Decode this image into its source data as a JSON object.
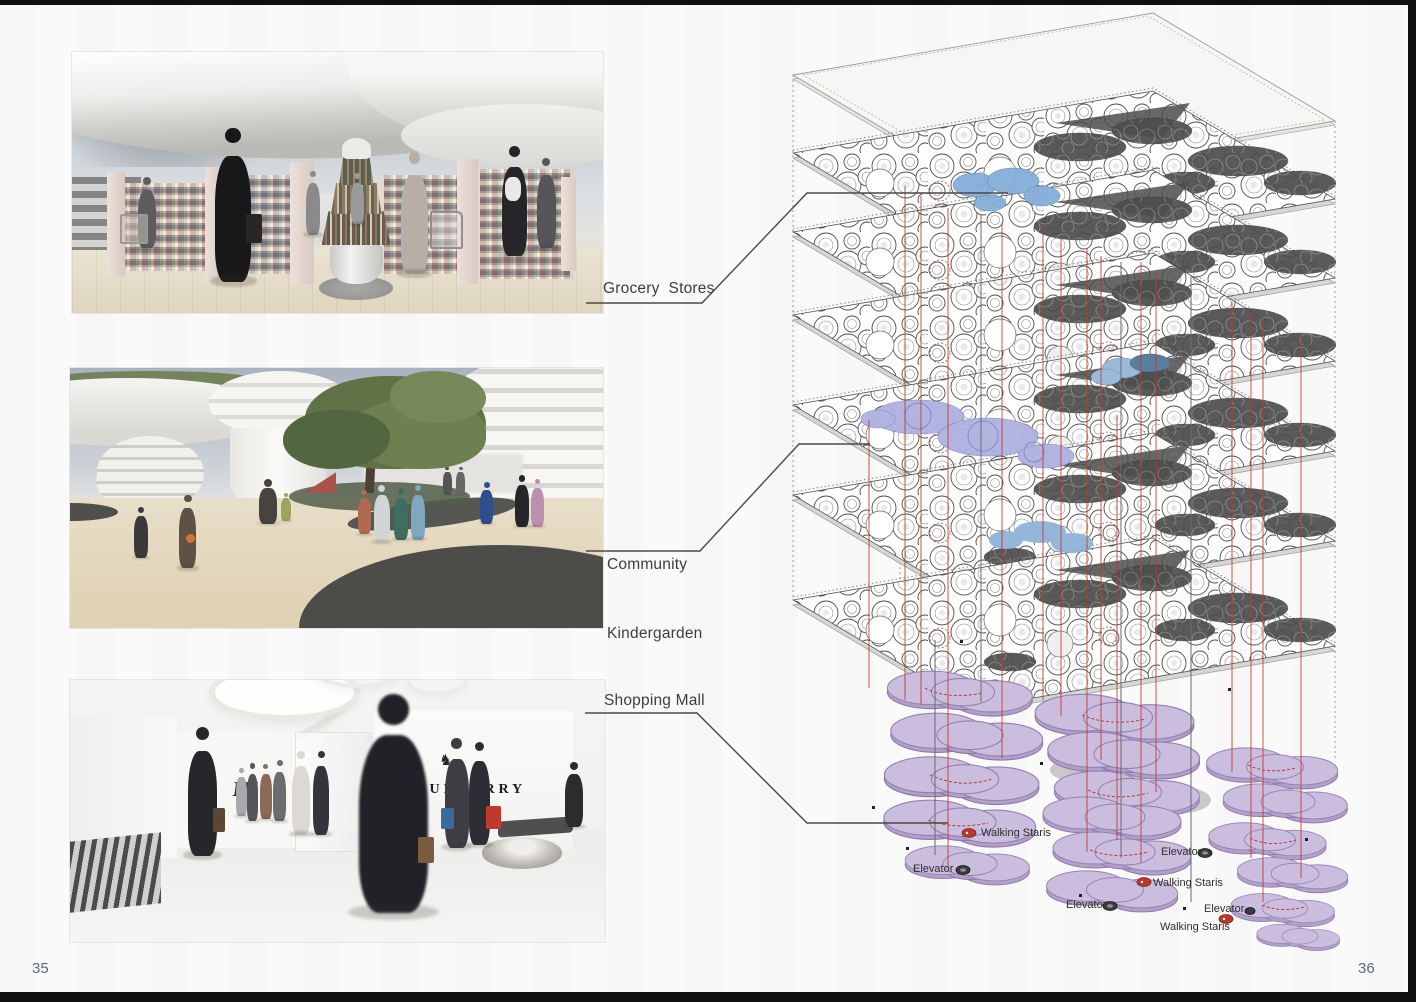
{
  "page": {
    "left_number": "35",
    "right_number": "36"
  },
  "callouts": {
    "grocery": "Grocery  Stores",
    "kindergarten_line1": "Community",
    "kindergarten_line2": "Kindergarden",
    "mall": "Shopping Mall"
  },
  "photos": {
    "mall": {
      "lv": "LV",
      "burberry": "BURBERRY",
      "burberry_city": "LONDON"
    }
  },
  "diagram": {
    "annotations": [
      {
        "text": "Walking Staris"
      },
      {
        "text": "Elevator"
      },
      {
        "text": "Elevator"
      },
      {
        "text": "Walking Staris"
      },
      {
        "text": "Elevator"
      },
      {
        "text": "Elevator"
      },
      {
        "text": "Walking Staris"
      }
    ]
  }
}
